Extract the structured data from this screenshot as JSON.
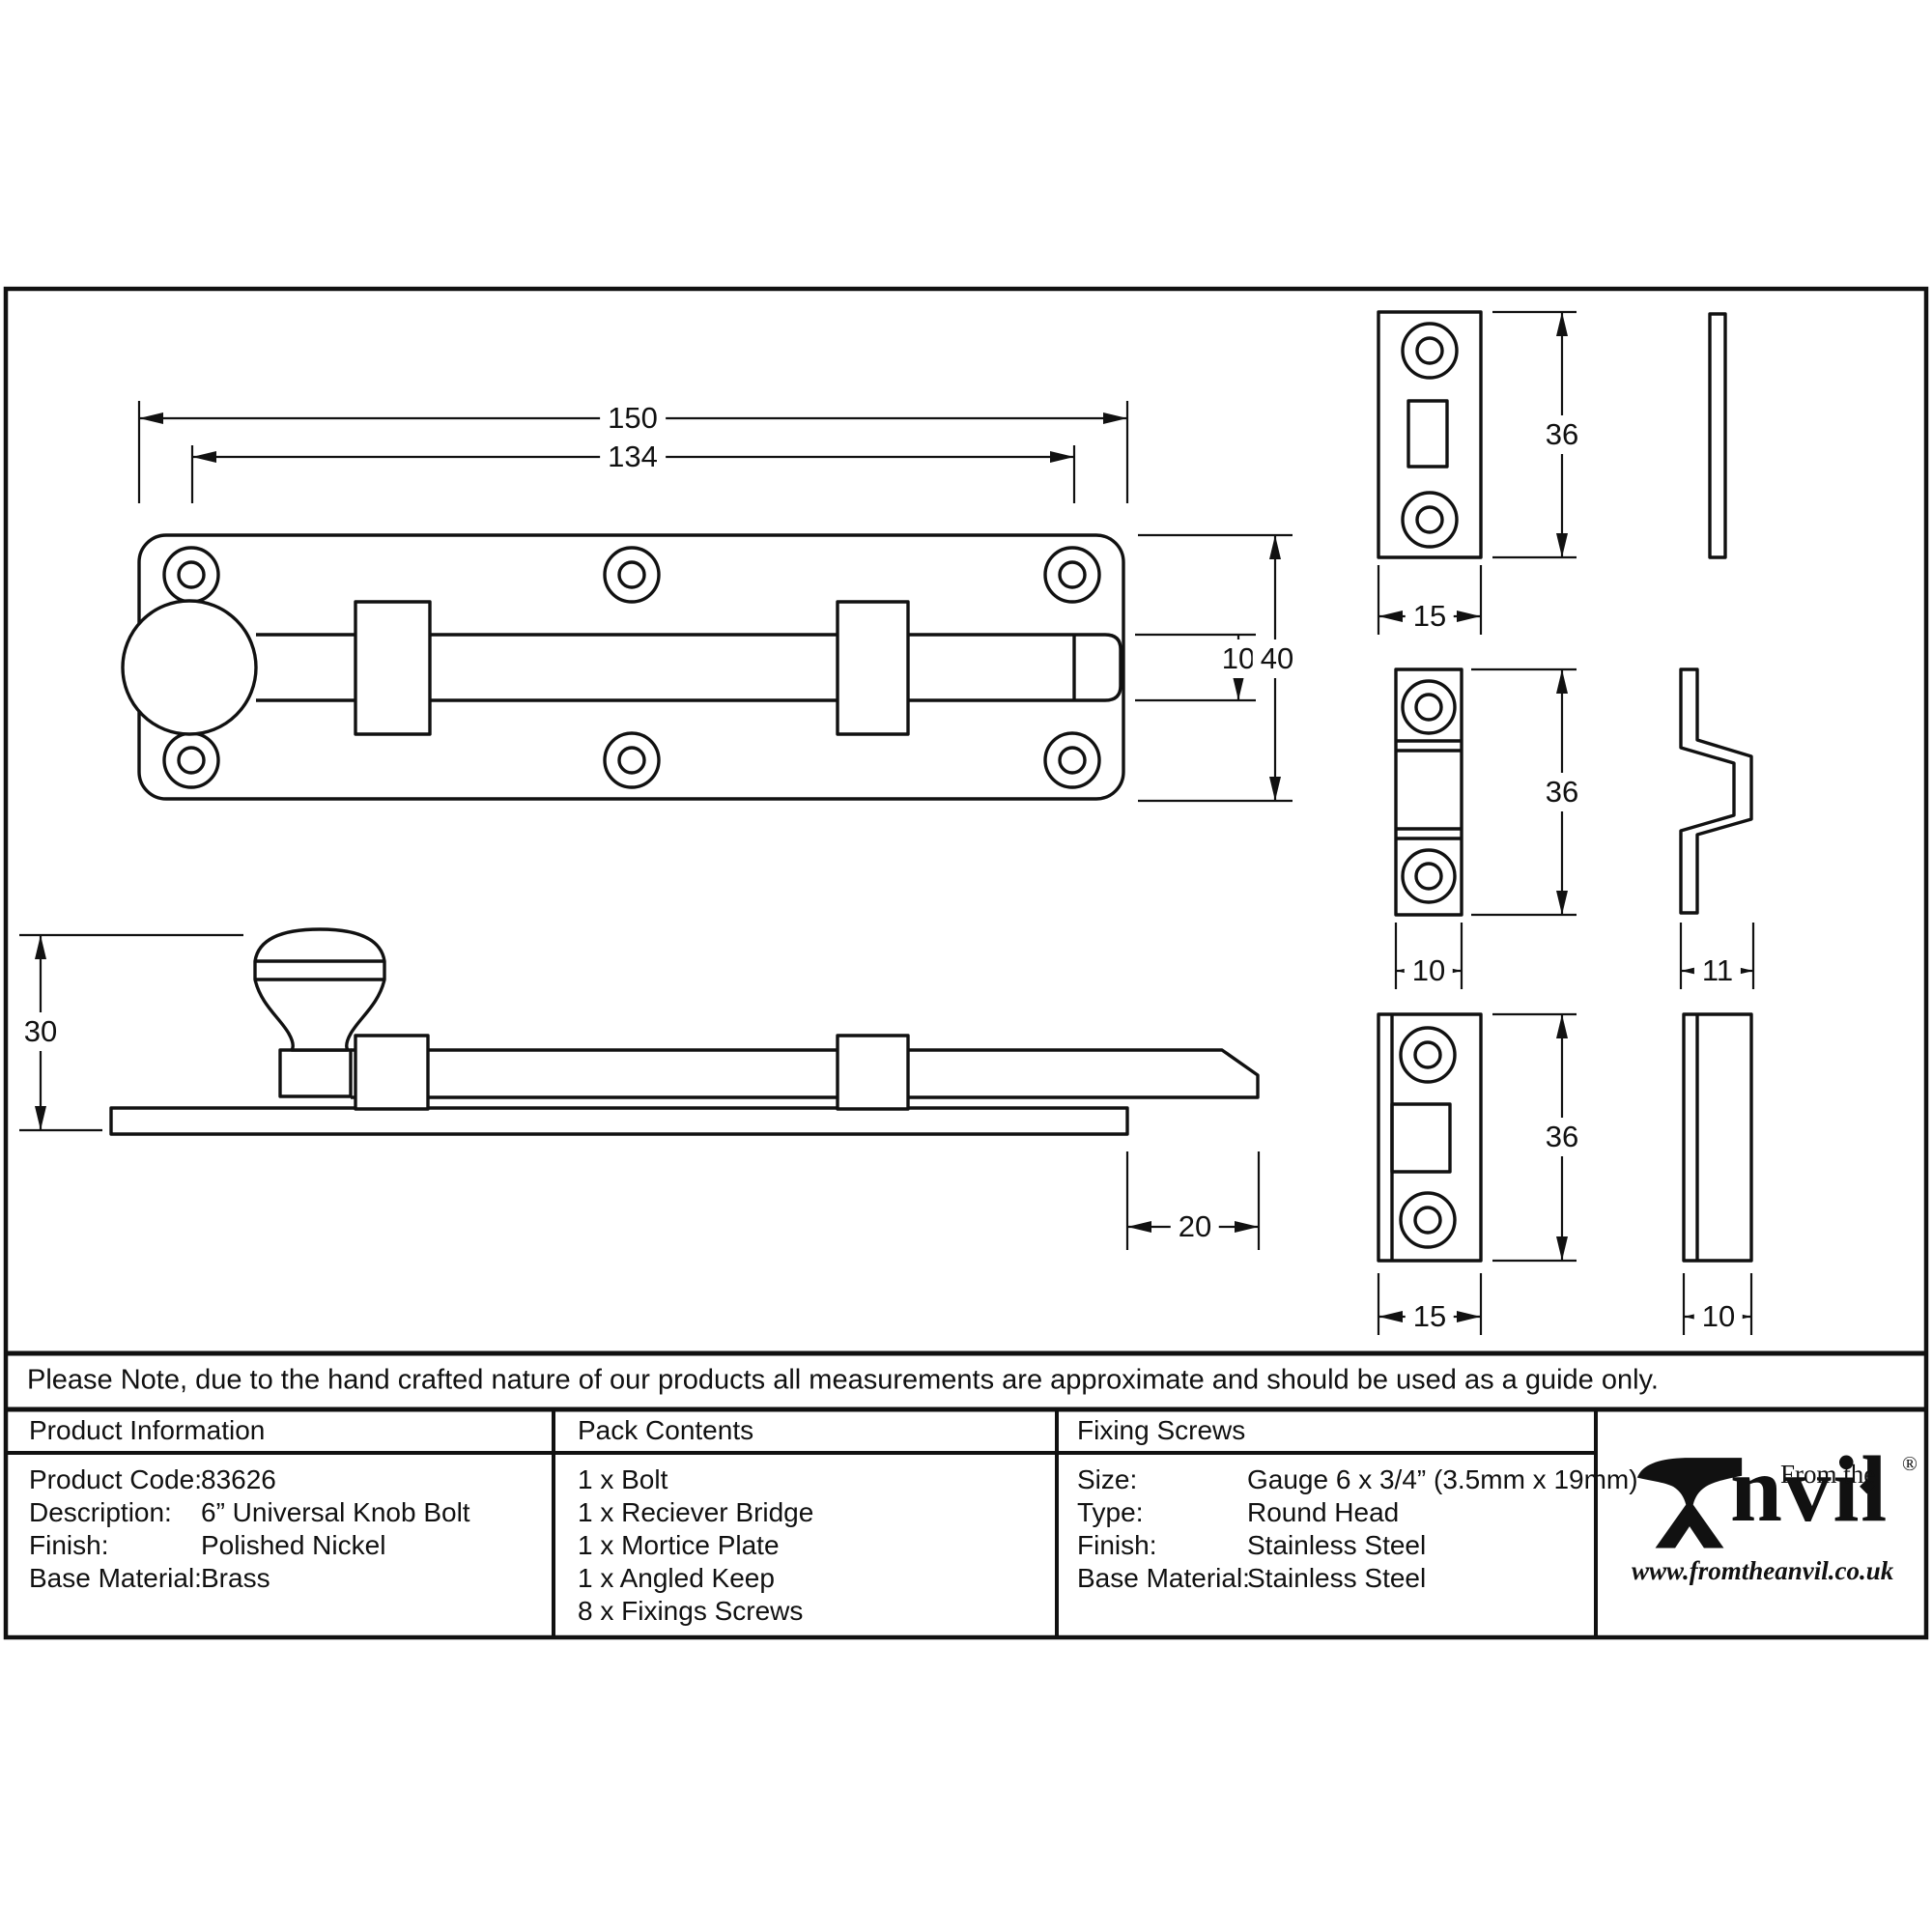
{
  "note": "Please Note, due to the hand crafted nature of our products all measurements are approximate and should be used as a guide only.",
  "drawing": {
    "dims": {
      "overall_length": "150",
      "fixing_centres": "134",
      "plate_width": "40",
      "bolt_width": "10",
      "side_height": "30",
      "throw": "20",
      "mortice_plate_height": "36",
      "mortice_plate_width": "15",
      "receiver_bridge_height": "36",
      "receiver_bridge_width": "10",
      "angled_keep_depth": "11",
      "angled_keep_height": "36",
      "angled_keep_width": "15",
      "angled_keep_side_width": "10"
    }
  },
  "tables": {
    "product_information": {
      "title": "Product Information",
      "rows": [
        {
          "label": "Product Code:",
          "value": "83626"
        },
        {
          "label": "Description:",
          "value": "6” Universal Knob Bolt"
        },
        {
          "label": "Finish:",
          "value": "Polished Nickel"
        },
        {
          "label": "Base Material:",
          "value": "Brass"
        }
      ]
    },
    "pack_contents": {
      "title": "Pack Contents",
      "items": [
        "1 x Bolt",
        "1 x Reciever Bridge",
        "1 x Mortice Plate",
        "1 x Angled Keep",
        "8 x Fixings Screws"
      ]
    },
    "fixing_screws": {
      "title": "Fixing Screws",
      "rows": [
        {
          "label": "Size:",
          "value": "Gauge 6 x 3/4” (3.5mm x 19mm)"
        },
        {
          "label": "Type:",
          "value": "Round Head"
        },
        {
          "label": "Finish:",
          "value": "Stainless Steel"
        },
        {
          "label": "Base Material:",
          "value": "Stainless Steel"
        }
      ]
    }
  },
  "logo": {
    "from_the": "From the",
    "anvil": "nvil",
    "diamond": "◆",
    "registered": "®",
    "website": "www.fromtheanvil.co.uk"
  }
}
